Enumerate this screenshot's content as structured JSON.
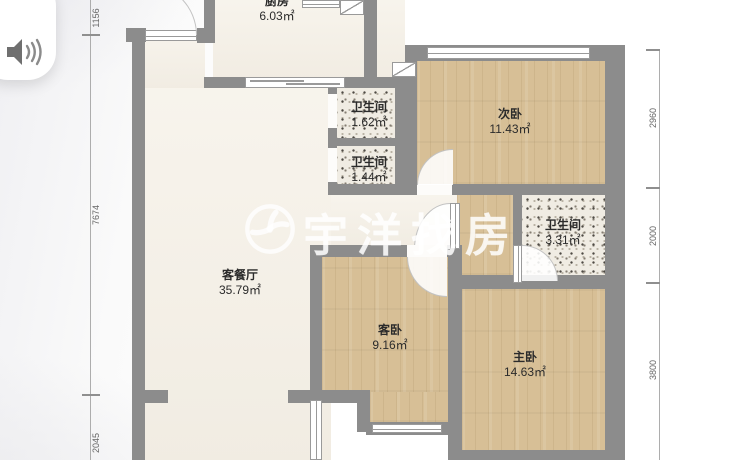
{
  "audio_button": {
    "icon": "speaker-waves-icon"
  },
  "watermark": {
    "logo_icon": "triskelion-circle-icon",
    "text": "宇洋找房"
  },
  "rooms": [
    {
      "id": "kitchen",
      "name": "厨房",
      "area": "6.03㎡"
    },
    {
      "id": "bathroom-1",
      "name": "卫生间",
      "area": "1.62㎡"
    },
    {
      "id": "bathroom-2",
      "name": "卫生间",
      "area": "1.44㎡"
    },
    {
      "id": "bedroom-second",
      "name": "次卧",
      "area": "11.43㎡"
    },
    {
      "id": "bathroom-3",
      "name": "卫生间",
      "area": "3.31㎡"
    },
    {
      "id": "living-dining",
      "name": "客餐厅",
      "area": "35.79㎡"
    },
    {
      "id": "bedroom-guest",
      "name": "客卧",
      "area": "9.16㎡"
    },
    {
      "id": "bedroom-master",
      "name": "主卧",
      "area": "14.63㎡"
    }
  ],
  "dimensions": {
    "left": [
      "1156",
      "7674",
      "2045"
    ],
    "right": [
      "2960",
      "2000",
      "3800"
    ]
  }
}
